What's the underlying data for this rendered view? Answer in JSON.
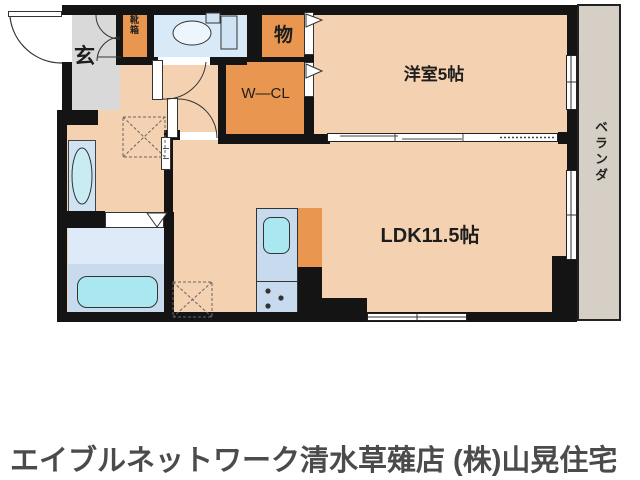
{
  "colors": {
    "wall": "#141414",
    "floor": "#f4d1b0",
    "closet": "#e99750",
    "genkan": "#d9d9d9",
    "water": "#d8e9f8",
    "vanity": "#cfe3f5",
    "bathfloor": "#dfeaf8",
    "counter": "#c7daee",
    "tub": "#a9e7f1",
    "veranda": "#d6cfc6",
    "title": "#4b4b4b"
  },
  "rooms": {
    "genkan": {
      "label": "玄"
    },
    "shoebox": {
      "label": "靴箱"
    },
    "storage": {
      "label": "物"
    },
    "wcl": {
      "label": "W—CL"
    },
    "western": {
      "label": "洋室5帖"
    },
    "ldk": {
      "label": "LDK11.5帖"
    },
    "veranda": {
      "label": "ベランダ"
    }
  },
  "fixtures": {
    "toilet": "toilet-icon",
    "bathtub": "bathtub-icon",
    "washbasin": "washbasin-icon",
    "kitchen_sink": "kitchen-sink-icon",
    "stove": "stove-burners-icon",
    "washer_space": "washing-machine-space",
    "fridge_space": "refrigerator-space"
  },
  "footer": {
    "title": "エイブルネットワーク清水草薙店 (株)山晃住宅"
  }
}
